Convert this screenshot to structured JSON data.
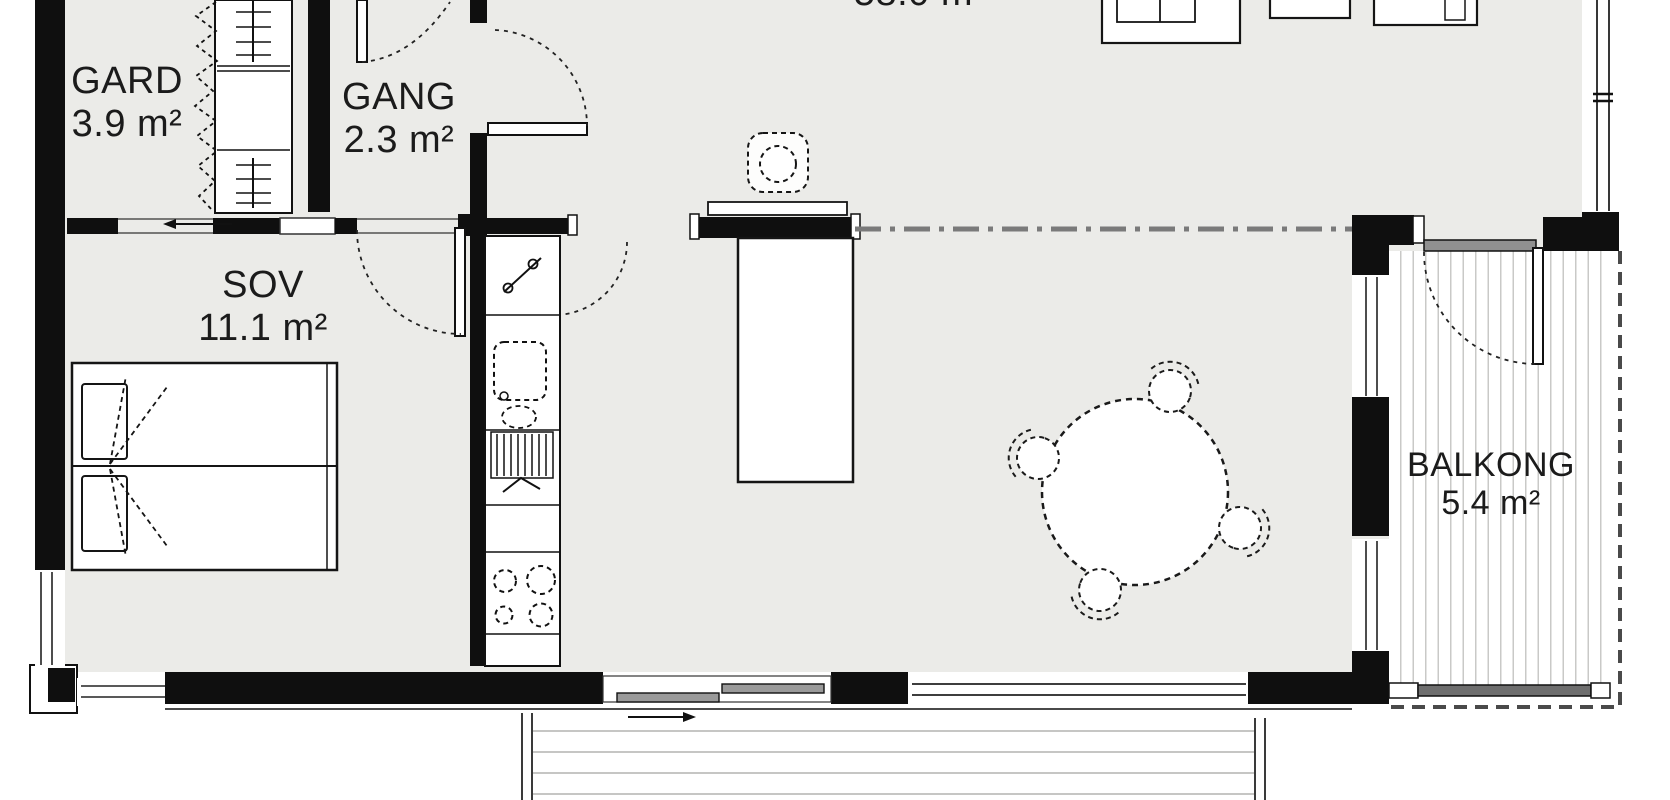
{
  "plan_title": "Apartment floor plan",
  "rooms": [
    {
      "id": "gard",
      "name": "GARD",
      "area": "3.9 m²"
    },
    {
      "id": "gang",
      "name": "GANG",
      "area": "2.3 m²"
    },
    {
      "id": "sov",
      "name": "SOV",
      "area": "11.1 m²"
    },
    {
      "id": "stue",
      "area": "58.0 m²"
    },
    {
      "id": "balkong",
      "name": "BALKONG",
      "area": "5.4 m²"
    }
  ],
  "colors": {
    "wall": "#0f0f0f",
    "floor": "#ebebe8",
    "deck_stripe": "#c9c9c7",
    "door_panel_gray": "#9a9a9a",
    "section_line_gray": "#7a7a7a",
    "text": "#1b1b1b"
  }
}
